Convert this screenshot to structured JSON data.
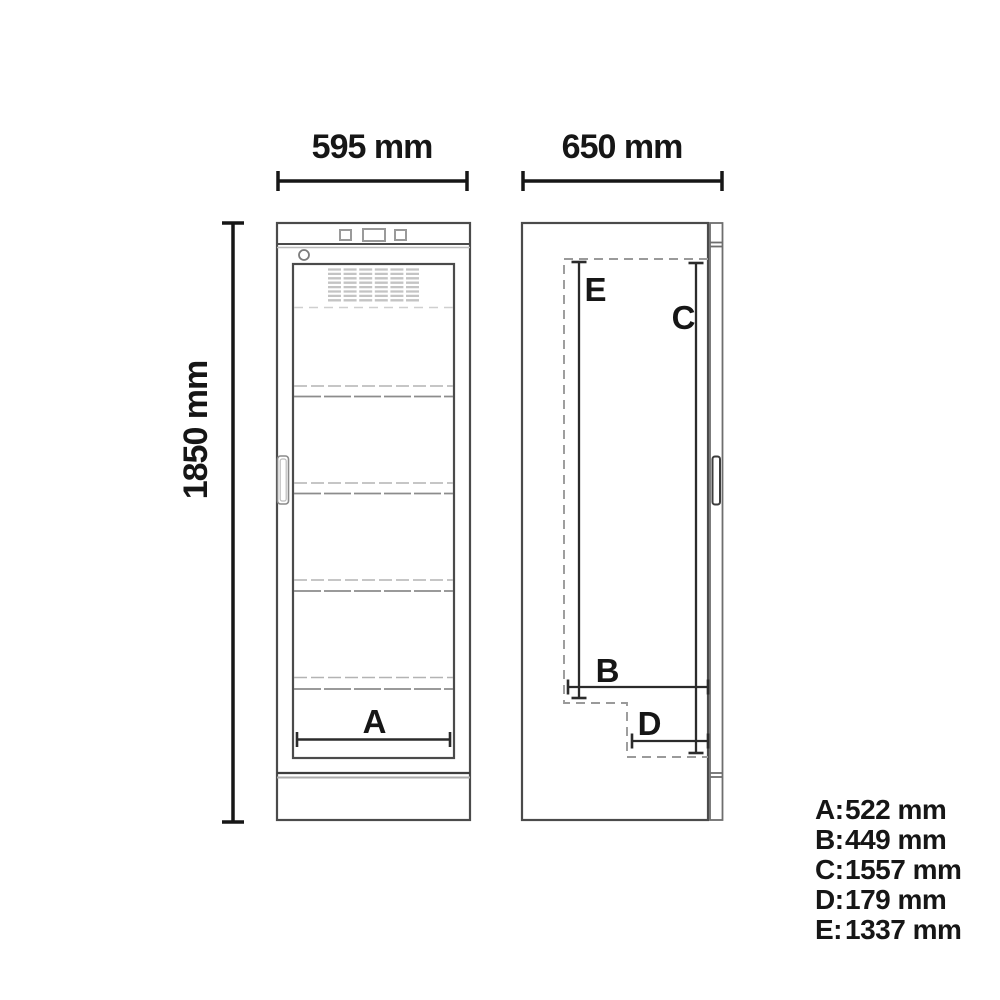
{
  "page": {
    "background": "#ffffff"
  },
  "dimensions": {
    "front_width_label": "595 mm",
    "side_depth_label": "650 mm",
    "height_label": "1850 mm"
  },
  "markers": {
    "a": "A",
    "b": "B",
    "c": "C",
    "d": "D",
    "e": "E"
  },
  "legend": {
    "items": [
      {
        "key": "A:",
        "value": "522 mm"
      },
      {
        "key": "B:",
        "value": "449 mm"
      },
      {
        "key": "C:",
        "value": "1557 mm"
      },
      {
        "key": "D:",
        "value": "179 mm"
      },
      {
        "key": "E:",
        "value": "1337 mm"
      }
    ]
  },
  "colors": {
    "outline": "#4b4b4b",
    "dimension": "#161616",
    "light_gray": "#b5b5b5",
    "mid_gray": "#8c8c8c",
    "dash_gray": "#9a9a9a",
    "grille": "#c4c4c4"
  }
}
